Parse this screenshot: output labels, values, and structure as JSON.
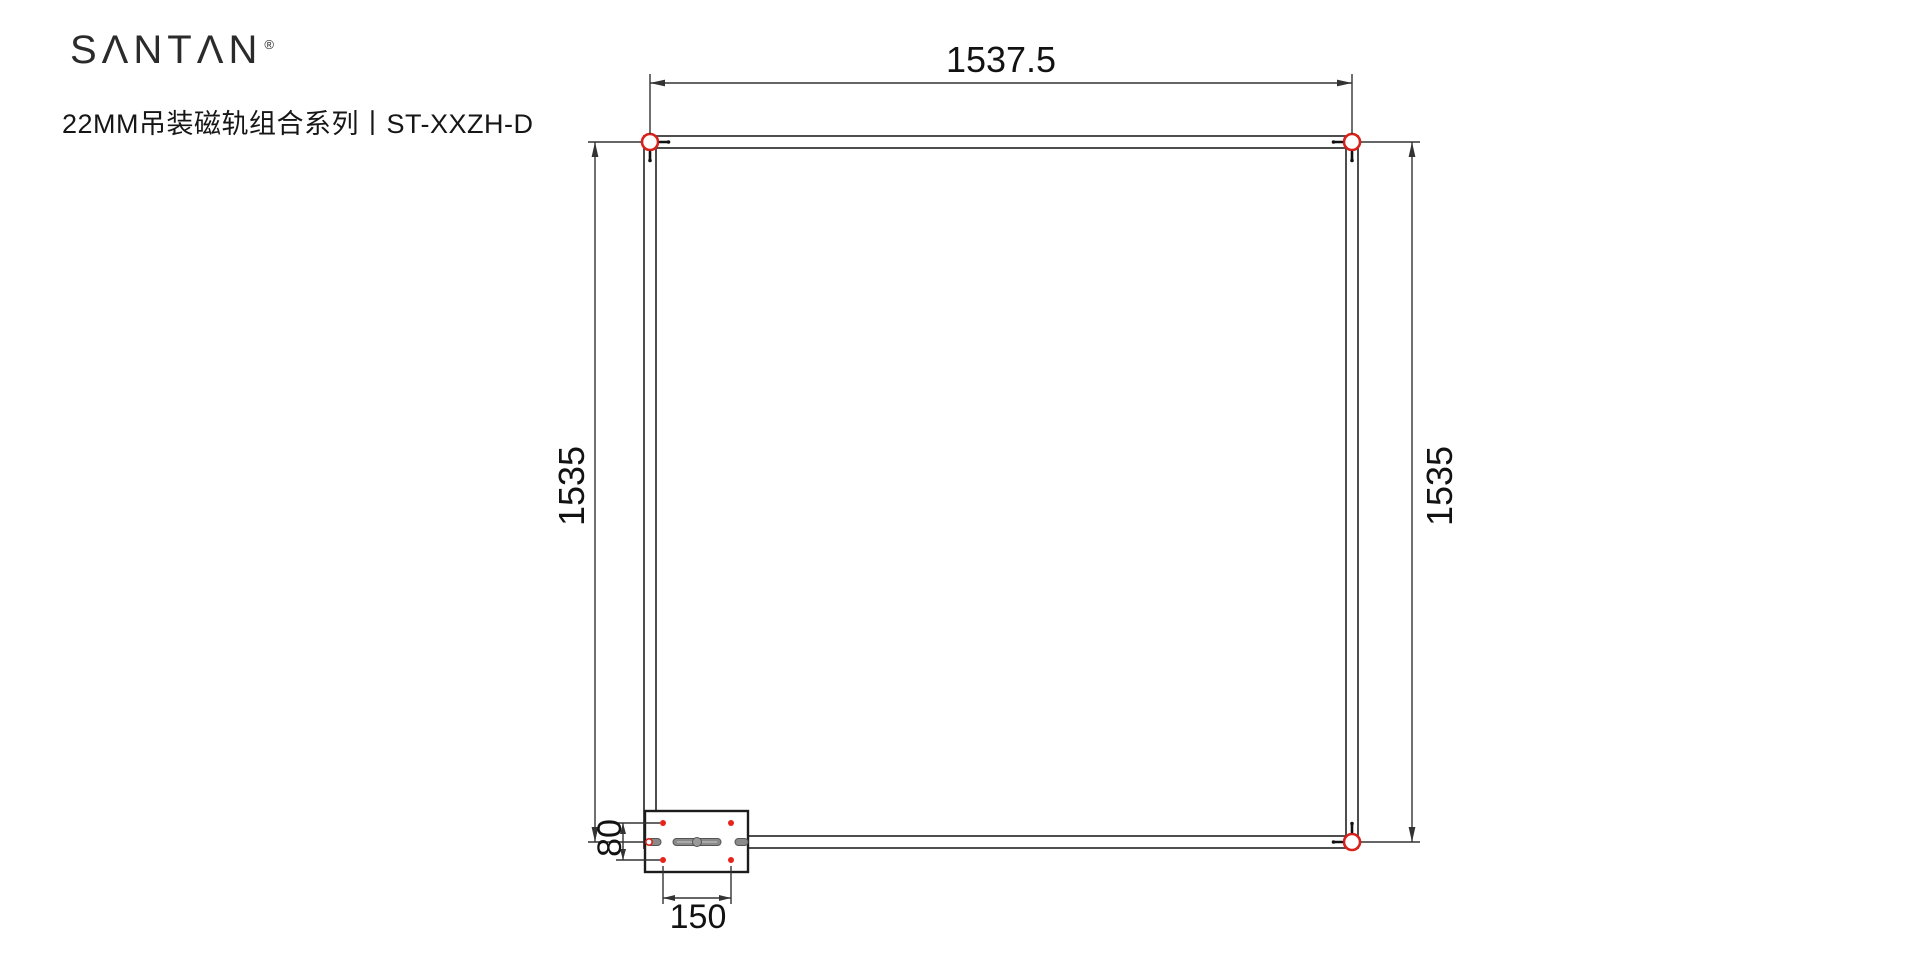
{
  "header": {
    "brand": "SΛNTΛN",
    "registered_mark": "®",
    "subtitle": "22MM吊装磁轨组合系列丨ST-XXZH-D"
  },
  "drawing": {
    "type": "technical-dimension-drawing",
    "dimensions": {
      "top_width": "1537.5",
      "left_height": "1535",
      "right_height": "1535",
      "feed_box_height": "80",
      "feed_box_width": "150"
    },
    "colors": {
      "line": "#3a3a3a",
      "accent_red": "#d8231d",
      "text": "#121212"
    }
  }
}
